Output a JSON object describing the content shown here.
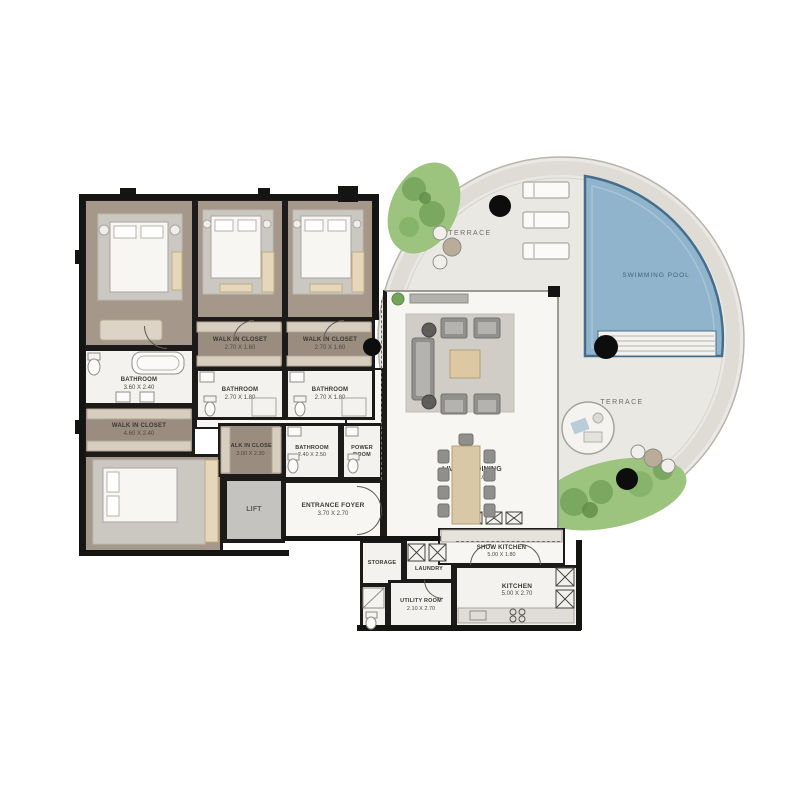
{
  "plan_title": "apartment-floor-plan",
  "rooms": {
    "master": {
      "name": "MASTER BEDROOM",
      "dims": "4.20 X 5.20"
    },
    "bedroom1": {
      "name": "BEDROOM 1",
      "dims": "4.00 X 4.60"
    },
    "bedroom2": {
      "name": "BEDROOM 2",
      "dims": "4.00 X 4.60"
    },
    "walkin1": {
      "name": "WALK IN CLOSET",
      "dims": "2.70 X 1.60"
    },
    "walkin2": {
      "name": "WALK IN CLOSET",
      "dims": "2.70 X 1.60"
    },
    "bath1": {
      "name": "BATHROOM",
      "dims": "2.70 X 1.80"
    },
    "bath2": {
      "name": "BATHROOM",
      "dims": "2.70 X 1.80"
    },
    "masterbath": {
      "name": "BATHROOM",
      "dims": "3.60 X 2.40"
    },
    "masterwalkin": {
      "name": "WALK IN CLOSET",
      "dims": "4.60 X 2.40"
    },
    "bedroom3": {
      "name": "BEDROOM 3",
      "dims": "6.10 X 3.95"
    },
    "walkin3": {
      "name": "WALK IN CLOSET",
      "dims": "3.00 X 2.30"
    },
    "lift": {
      "name": "LIFT",
      "dims": ""
    },
    "bathmid": {
      "name": "BATHROOM",
      "dims": "2.40 X 2.50"
    },
    "power": {
      "name": "POWER ROOM",
      "dims": ""
    },
    "foyer": {
      "name": "ENTRANCE FOYER",
      "dims": "3.70 X 2.70"
    },
    "living": {
      "name": "LIVING & DINING",
      "dims": "8.60 X 11.00"
    },
    "storage": {
      "name": "STORAGE",
      "dims": ""
    },
    "laundry": {
      "name": "LAUNDRY",
      "dims": ""
    },
    "utility": {
      "name": "UTILITY ROOM",
      "dims": "2.10 X 2.70"
    },
    "kitchen": {
      "name": "KITCHEN",
      "dims": "5.00 X 2.70"
    },
    "showkitchen": {
      "name": "SHOW KITCHEN",
      "dims": "5.00 X 1.80"
    }
  },
  "outdoor": {
    "terrace_upper": "TERRACE",
    "terrace_lower": "TERRACE",
    "pool": "SWIMMING POOL"
  },
  "colors": {
    "pool_water": "#8fb4cc",
    "pool_edge": "#456e8c",
    "terrace_floor": "#eae8e3",
    "greenery": "#9cc47e",
    "bedroom_floor": "#a59789",
    "wall": "#141413"
  }
}
